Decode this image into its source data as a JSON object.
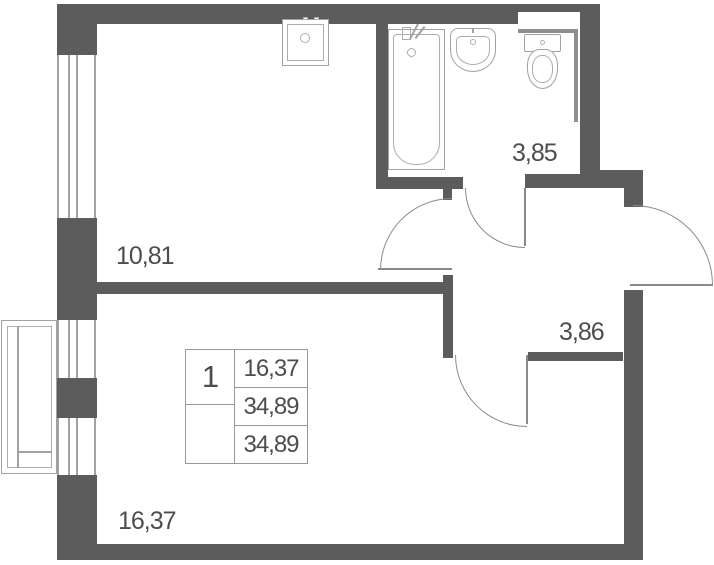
{
  "plan": {
    "rooms": [
      {
        "name": "kitchen-living",
        "area": "10,81"
      },
      {
        "name": "bathroom",
        "area": "3,85"
      },
      {
        "name": "hallway",
        "area": "3,86"
      },
      {
        "name": "room",
        "area": "16,37"
      }
    ],
    "info_table": {
      "rooms_count": "1",
      "row1": "16,37",
      "row2": "34,89",
      "row3": "34,89"
    },
    "fixtures": [
      "kitchen-sink",
      "bathtub",
      "washbasin",
      "toilet",
      "balcony",
      "window"
    ],
    "colors": {
      "wall": "#5c5c5c",
      "fixture_line": "#a2a2a2",
      "door_line": "#8a8a8a",
      "table_border": "#999999",
      "text": "#4d4d4d",
      "background": "#ffffff"
    }
  }
}
